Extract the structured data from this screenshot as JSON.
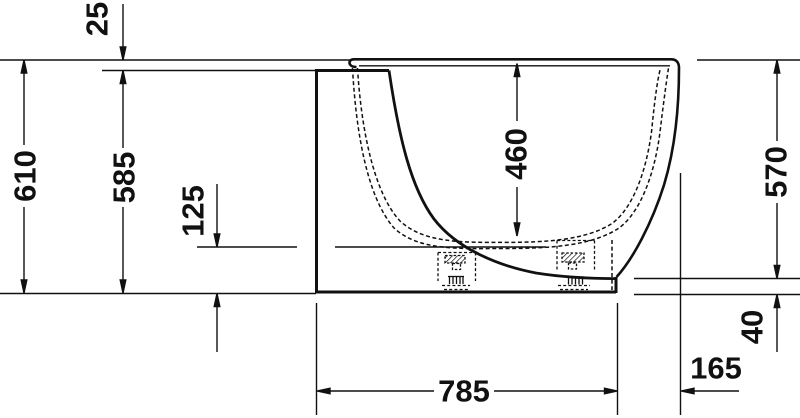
{
  "drawing": {
    "kind": "technical dimension drawing",
    "subject": "freestanding bathtub, side elevation",
    "units": "mm",
    "colors": {
      "line": "#111111",
      "background": "#ffffff"
    },
    "dims": {
      "d25": {
        "label": "25",
        "value": 25,
        "orientation": "vertical"
      },
      "d610": {
        "label": "610",
        "value": 610,
        "orientation": "vertical"
      },
      "d585": {
        "label": "585",
        "value": 585,
        "orientation": "vertical"
      },
      "d125": {
        "label": "125",
        "value": 125,
        "orientation": "vertical"
      },
      "d460": {
        "label": "460",
        "value": 460,
        "orientation": "vertical"
      },
      "d570": {
        "label": "570",
        "value": 570,
        "orientation": "vertical"
      },
      "d40": {
        "label": "40",
        "value": 40,
        "orientation": "vertical"
      },
      "d785": {
        "label": "785",
        "value": 785,
        "orientation": "horizontal"
      },
      "d165": {
        "label": "165",
        "value": 165,
        "orientation": "horizontal"
      }
    }
  }
}
